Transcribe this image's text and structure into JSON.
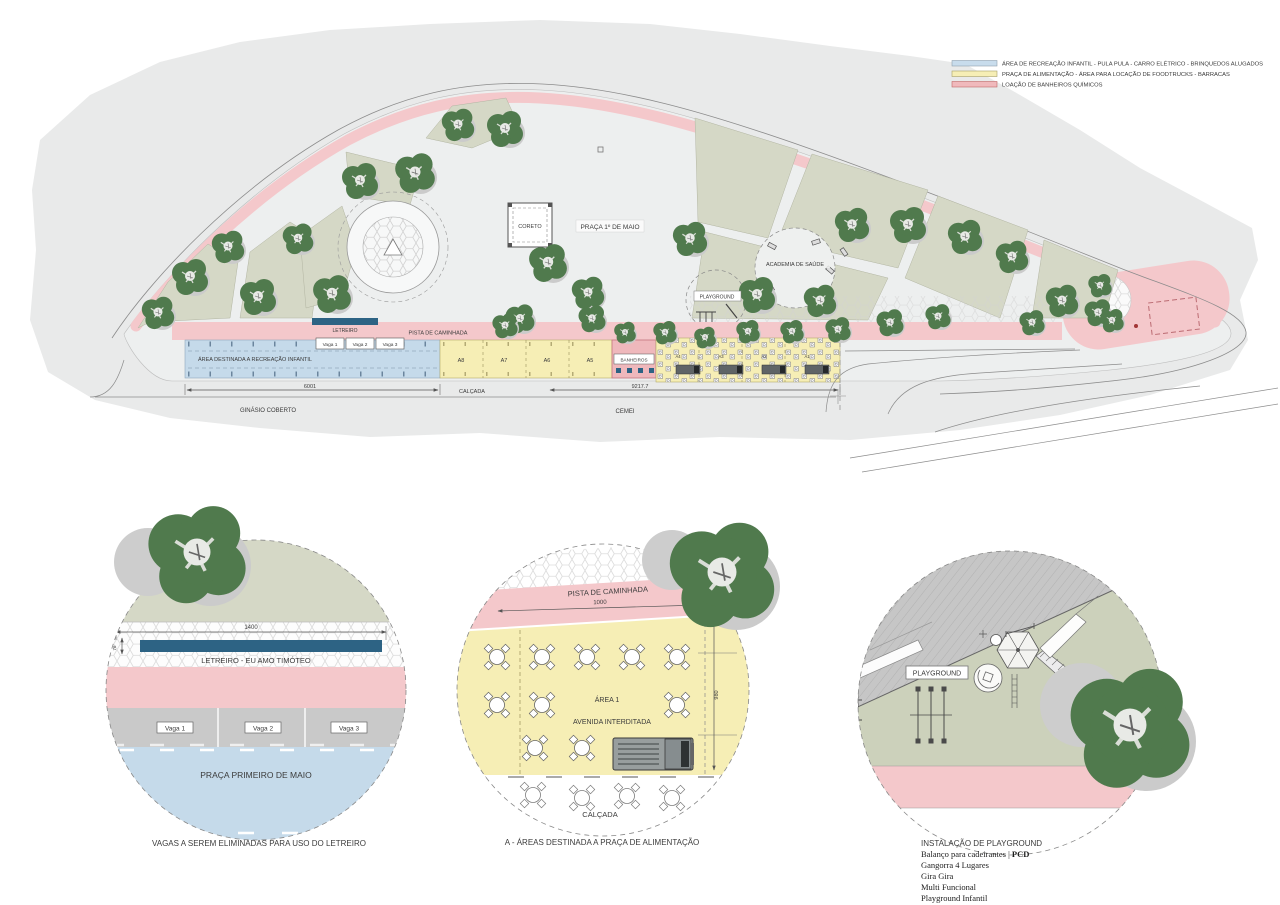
{
  "legend": {
    "items": [
      {
        "label": "ÁREA DE RECREAÇÃO INFANTIL - PULA PULA - CARRO ELÉTRICO - BRINQUEDOS ALUGADOS",
        "color": "#c8dcec"
      },
      {
        "label": "PRAÇA DE ALIMENTAÇÃO - ÁREA PARA LOCAÇÃO DE FOODTRUCKS - BARRACAS",
        "color": "#f6eeb5"
      },
      {
        "label": "LOAÇÃO DE BANHEIROS QUÍMICOS",
        "color": "#f0b9bc"
      }
    ]
  },
  "site_plan": {
    "labels": {
      "praca": "PRAÇA 1º DE MAIO",
      "coreto": "CORETO",
      "academia": "ACADEMIA DE SAÚDE",
      "playground": "PLAYGROUND",
      "letreiro": "LETREIRO",
      "pista": "PISTA DE CAMINHADA",
      "recreacao": "ÁREA DESTINADA A RECREAÇÃO INFANTIL",
      "vagas": [
        "Vaga 1",
        "Vaga 2",
        "Vaga 3"
      ],
      "food_areas": [
        "A8",
        "A7",
        "A6",
        "A5"
      ],
      "food_sections": [
        "A4",
        "A3",
        "A2",
        "A1"
      ],
      "banheiros": "BANHEIROS",
      "dim_recreacao": "6001",
      "calcada": "CALÇADA",
      "dim_total": "9217.7",
      "ginasio": "GINÁSIO COBERTO",
      "cemei": "CEMEI"
    }
  },
  "detail_letreiro": {
    "dim_width": "1400",
    "dim_height": "76",
    "letreiro": "LETREIRO - EU AMO TIMÓTEO",
    "vagas": [
      "Vaga 1",
      "Vaga 2",
      "Vaga 3"
    ],
    "praca": "PRAÇA PRIMEIRO DE MAIO",
    "caption": "VAGAS A SEREM ELIMINADAS PARA USO DO LETREIRO"
  },
  "detail_alimentacao": {
    "pista": "PISTA DE CAMINHADA",
    "dim_width": "1000",
    "dim_height": "980",
    "area": "ÁREA 1",
    "avenida": "AVENIDA INTERDITADA",
    "calcada": "CALÇADA",
    "caption": "A - ÁREAS DESTINADA A PRAÇA DE ALIMENTAÇÃO"
  },
  "detail_playground": {
    "label": "PLAYGROUND",
    "caption_title": "INSTALAÇÃO DE PLAYGROUND",
    "line1_normal": "Balanço para cadeirantes | ",
    "line1_bold": "PCD",
    "lines": [
      "Gangorra 4 Lugares",
      "Gira Gira",
      "Multi Funcional",
      "Playground Infantil"
    ]
  },
  "colors": {
    "track_pink": "#f4c8cb",
    "recreacao_blue": "#c5daea",
    "alimentacao_yellow": "#f6eeb5",
    "banheiros_pink": "#efb8bc",
    "letreiro_blue": "#2d6384",
    "bed_olive": "#d5d8c6",
    "ground_olive": "#ccd1bb",
    "tree_green": "#507a4d",
    "terrain_gray": "#e9eaea",
    "paving_gray": "#edefef",
    "vaga_gray": "#c9c9c9",
    "street_gray": "#c6c6c6"
  }
}
